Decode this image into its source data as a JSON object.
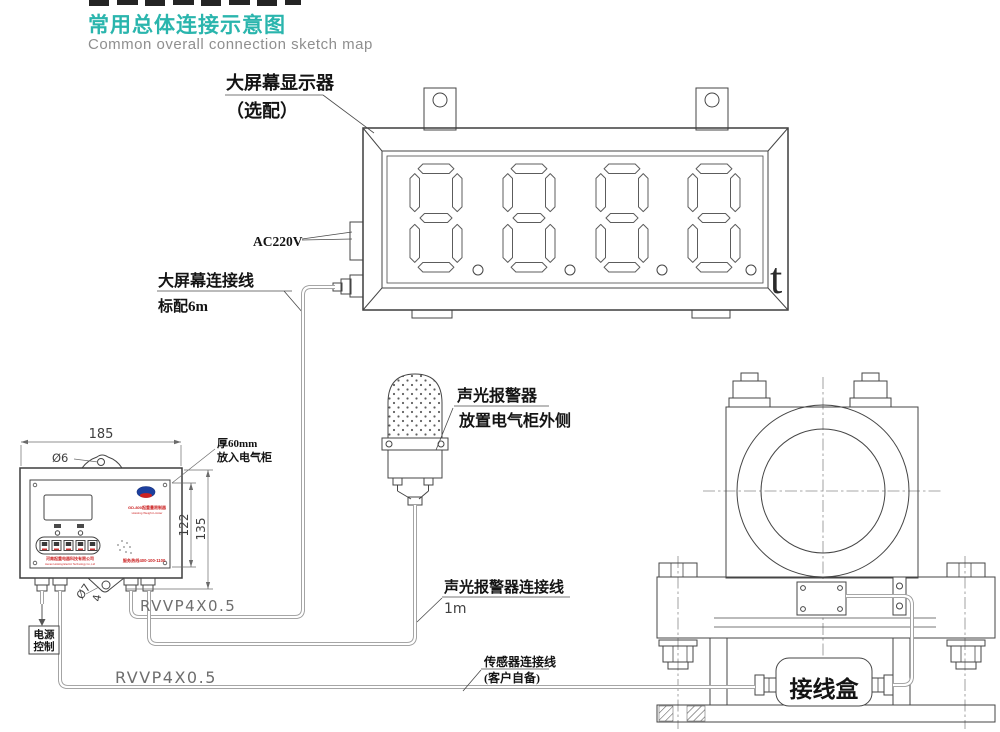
{
  "header": {
    "title": "常用总体连接示意图",
    "subtitle": "Common overall connection sketch map",
    "accent_color": "#2ab5ad"
  },
  "big_display": {
    "label_line1": "大屏幕显示器",
    "label_line2": "（选配）",
    "power_label": "AC220V",
    "value": "8888",
    "unit": "t",
    "cable_label_line1": "大屏幕连接线",
    "cable_label_line2": "标配6m",
    "cable_type_label": "RVVP4X0.5"
  },
  "controller": {
    "dims": {
      "width": "185",
      "hole_top": "Ø6",
      "inner_height": "122",
      "outer_height": "135",
      "hole_bottom": "Ø7",
      "offset": "4"
    },
    "note_line1": "厚60mm",
    "note_line2": "放入电气柜",
    "panel": {
      "model_cn": "GD-800起重量限制器",
      "model_en": "Hoisting Weight Limiter",
      "company_cn": "河南起重电器科技有限公司",
      "company_en": "Henan Hoisting Electric Technology Co.,Ltd",
      "hotline": "服务热线400-100-1100"
    },
    "power_out_line1": "电源",
    "power_out_line2": "控制"
  },
  "alarm": {
    "label_line1": "声光报警器",
    "label_line2": "放置电气柜外侧",
    "cable_label": "声光报警器连接线",
    "cable_length": "1m"
  },
  "sensor": {
    "cable_label_line1": "传感器连接线",
    "cable_label_line2": "(客户自备)",
    "cable_type_label": "RVVP4X0.5"
  },
  "junction_box": {
    "label": "接线盒"
  }
}
